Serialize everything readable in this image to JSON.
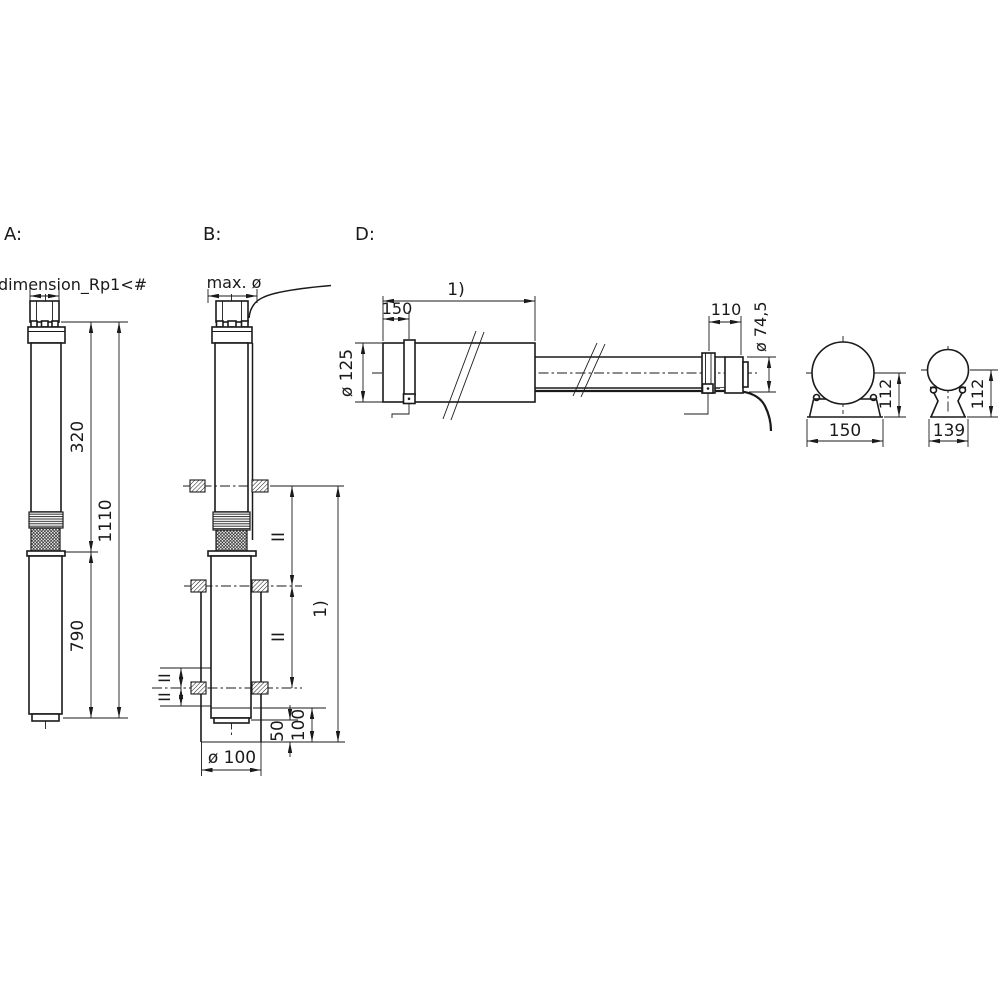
{
  "colors": {
    "line": "#1a1a1a",
    "background": "#ffffff"
  },
  "view_a": {
    "label": "A:",
    "connection_dim": "dimension_Rp1<#",
    "pump_length": "320",
    "total_length": "1110",
    "motor_length": "790"
  },
  "view_b": {
    "label": "B:",
    "max_diameter": "max. ø",
    "clamp_spacing_upper": "II",
    "clamp_spacing_lower": "II",
    "left_spacing_upper": "II",
    "left_spacing_lower": "II",
    "installation_depth": "1)",
    "bottom_distance": "100",
    "floor_clearance": "50",
    "well_diameter": "ø 100"
  },
  "view_d": {
    "label": "D:",
    "length": "1)",
    "clamp_offset": "150",
    "end_offset": "110",
    "pump_diameter": "ø 74,5",
    "motor_diameter": "ø 125",
    "motor_section": {
      "height": "112",
      "width": "150"
    },
    "pump_section": {
      "height": "112",
      "width": "139"
    }
  }
}
